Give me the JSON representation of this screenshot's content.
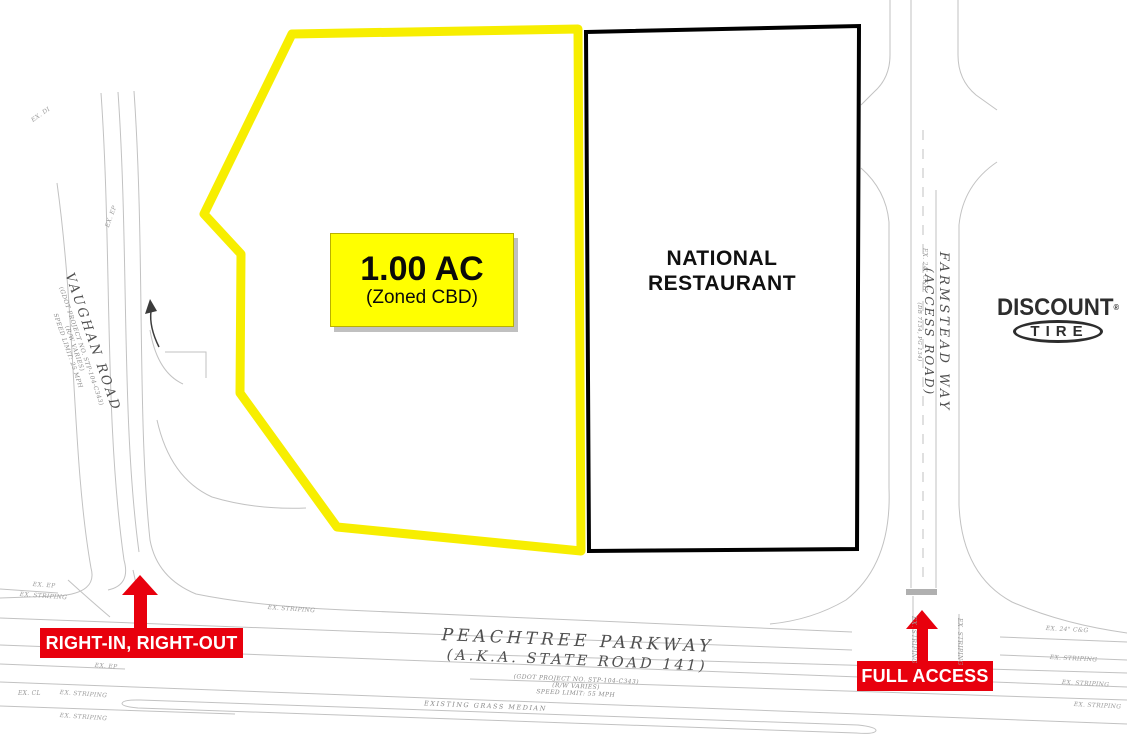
{
  "parcel": {
    "area": "1.00 AC",
    "zoning": "(Zoned CBD)"
  },
  "restaurant_label": "NATIONAL RESTAURANT",
  "logo": {
    "name": "DISCOUNT",
    "reg": "®",
    "sub": "TIRE"
  },
  "access_labels": {
    "right_in_right_out": "RIGHT-IN, RIGHT-OUT",
    "full_access": "FULL ACCESS"
  },
  "roads": {
    "vaughan": {
      "name": "VAUGHAN ROAD",
      "project": "(GDOT PROJECT NO. STP-104-C343)",
      "rw": "(R/W VARIES)",
      "speed": "SPEED LIMIT: 25 MPH"
    },
    "peachtree": {
      "name": "PEACHTREE PARKWAY",
      "aka": "(A.K.A. STATE ROAD 141)",
      "project": "(GDOT PROJECT NO. STP-104-C343)",
      "rw": "(R/W VARIES)",
      "speed": "SPEED LIMIT: 55 MPH"
    },
    "farmstead": {
      "name": "FARMSTEAD WAY",
      "aka": "(ACCESS ROAD)",
      "deed": "(DB 7134, PG 134)"
    },
    "median": "EXISTING GRASS MEDIAN"
  },
  "annotations": [
    {
      "t": "EX. DI",
      "x": 30,
      "y": 118,
      "r": -35
    },
    {
      "t": "EX. EP",
      "x": 104,
      "y": 226,
      "r": -70
    },
    {
      "t": "EX. EP",
      "x": 33,
      "y": 581,
      "r": 4
    },
    {
      "t": "EX. STRIPING",
      "x": 20,
      "y": 591,
      "r": 4
    },
    {
      "t": "EX. STRIPING",
      "x": 268,
      "y": 604,
      "r": 4
    },
    {
      "t": "EX. EP",
      "x": 95,
      "y": 662,
      "r": 4
    },
    {
      "t": "EX. CL",
      "x": 18,
      "y": 690,
      "r": 0
    },
    {
      "t": "EX. STRIPING",
      "x": 60,
      "y": 689,
      "r": 4
    },
    {
      "t": "EX. STRIPING",
      "x": 60,
      "y": 712,
      "r": 4
    },
    {
      "t": "EX. 24\" C&G",
      "x": 1046,
      "y": 625,
      "r": 3
    },
    {
      "t": "EX. STRIPING",
      "x": 1050,
      "y": 654,
      "r": 3
    },
    {
      "t": "EX. STRIPING",
      "x": 1062,
      "y": 679,
      "r": 3
    },
    {
      "t": "EX. STRIPING",
      "x": 1074,
      "y": 701,
      "r": 3
    },
    {
      "t": "EX. 24\" C&G",
      "x": 928,
      "y": 248,
      "r": 90
    },
    {
      "t": "EX. STRIPING",
      "x": 917,
      "y": 616,
      "r": 90
    },
    {
      "t": "EX. STRIPING",
      "x": 963,
      "y": 618,
      "r": 90
    }
  ],
  "colors": {
    "parcel_outline": "#f7ee00",
    "parcel_label_bg": "#ffff00",
    "access_red": "#e8000d",
    "restaurant_outline": "#000000",
    "linework": "#c2c2c2"
  }
}
